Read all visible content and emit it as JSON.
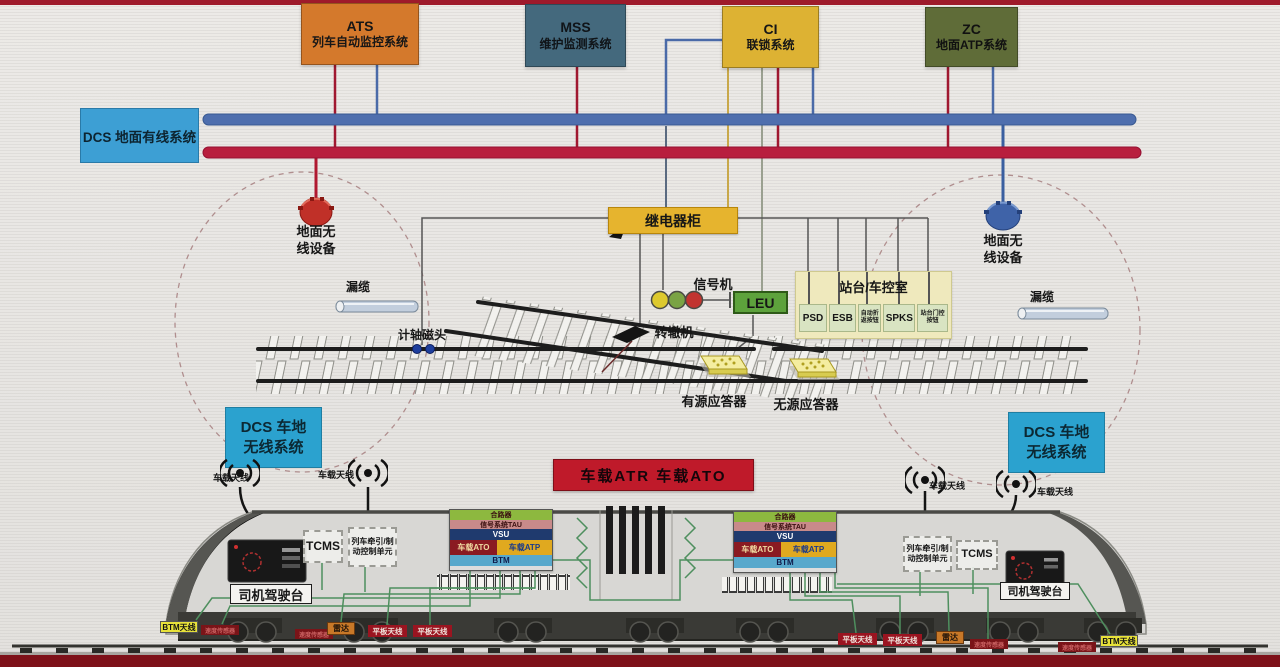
{
  "page": {
    "background": "#e9e7e4",
    "frame_red": "#9e1a2b"
  },
  "top_systems": [
    {
      "abbr": "ATS",
      "name": "列车自动监控系统",
      "color": "#d4792c"
    },
    {
      "abbr": "MSS",
      "name": "维护监测系统",
      "color": "#44697d"
    },
    {
      "abbr": "CI",
      "name": "联锁系统",
      "color": "#ddb233"
    },
    {
      "abbr": "ZC",
      "name": "地面ATP系统",
      "color": "#5f6c38"
    }
  ],
  "dcs_wired": {
    "label": "DCS 地面有线系统",
    "color": "#3d9fd4",
    "bus_blue": "#4f6fae",
    "bus_red": "#b81e3e"
  },
  "wayside": {
    "relay_cabinet": "继电器柜",
    "signal_machine": "信号机",
    "signal_lights": [
      "yellow",
      "green",
      "red"
    ],
    "leu": "LEU",
    "station_panel": {
      "title": "站台/车控室",
      "buttons": [
        "PSD",
        "ESB",
        "自动折返按钮",
        "SPKS",
        "站台门控按钮"
      ]
    },
    "ground_radio": "地面无线设备",
    "leaky_cable": "漏缆",
    "axle_counter": "计轴磁头",
    "point_machine": "转辙机",
    "active_balise": "有源应答器",
    "passive_balise": "无源应答器"
  },
  "dcs_radio": {
    "label": "DCS 车地无线系统",
    "color": "#2ba2cf"
  },
  "onboard_banner": {
    "label": "车载ATR  车载ATO",
    "color": "#bf1a2a"
  },
  "train": {
    "antenna_label": "车载天线",
    "driver_console": "司机驾驶台",
    "tcms": "TCMS",
    "traction_unit": "列车牵引/制动控制单元",
    "equipment_stack": {
      "combiner": "合路器",
      "tau": "信号系统TAU",
      "vsu": "VSU",
      "ato": "车载ATO",
      "atp": "车载ATP",
      "btm": "BTM"
    },
    "underside": {
      "btm_antenna": "BTM天线",
      "speed_sensor": "速度传感器",
      "radar": "雷达",
      "plate_antenna": "平板天线"
    }
  }
}
